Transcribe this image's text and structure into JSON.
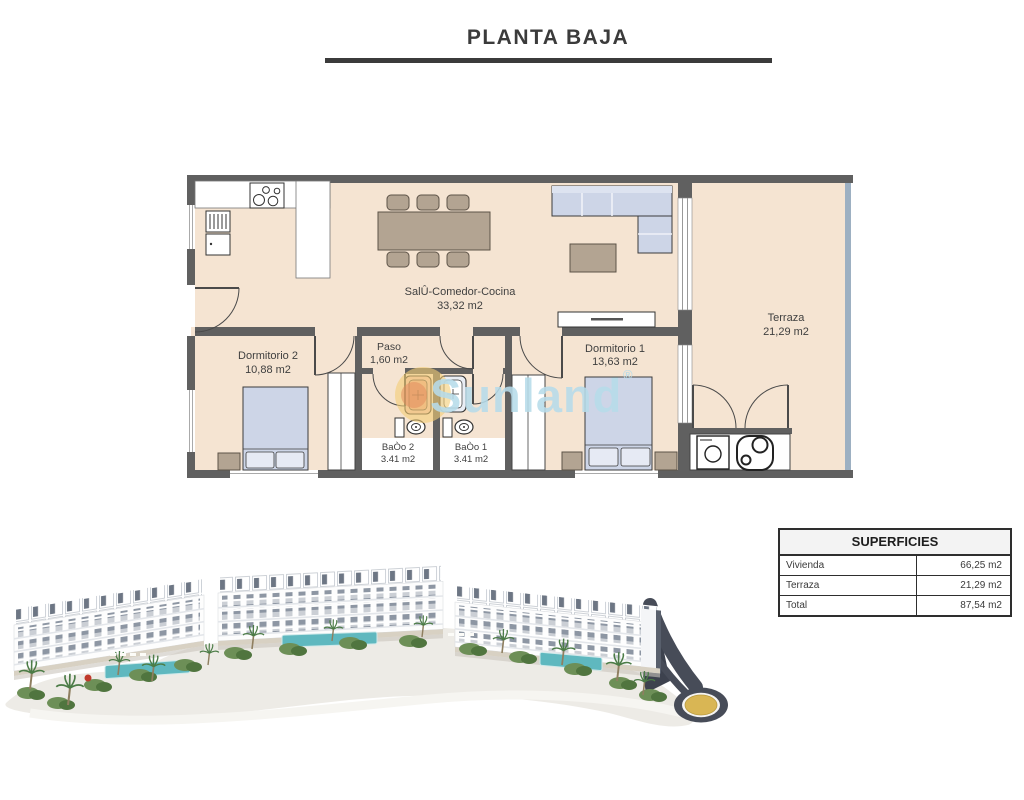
{
  "title": "PLANTA BAJA",
  "floorplan": {
    "rooms": [
      {
        "name": "SalÛ-Comedor-Cocina",
        "area": "33,32 m2"
      },
      {
        "name": "Terraza",
        "area": "21,29 m2"
      },
      {
        "name": "Dormitorio 2",
        "area": "10,88 m2"
      },
      {
        "name": "Dormitorio 1",
        "area": "13,63 m2"
      },
      {
        "name": "Paso",
        "area": "1,60 m2"
      },
      {
        "name": "BaÒo 2",
        "area": "3.41 m2"
      },
      {
        "name": "BaÒo 1",
        "area": "3.41 m2"
      }
    ],
    "watermark": {
      "text": "Sunland",
      "reg": "®"
    }
  },
  "table": {
    "header": "SUPERFICIES",
    "rows": [
      {
        "label": "Vivienda",
        "value": "66,25 m2"
      },
      {
        "label": "Terraza",
        "value": "21,29 m2"
      },
      {
        "label": "Total",
        "value": "87,54 m2"
      }
    ]
  },
  "colors": {
    "floor": "#f5e4d2",
    "wall": "#606060",
    "watermark_blue": "#b7dcea",
    "furniture_wood": "#b3a492",
    "furniture_soft": "#cdd5e7",
    "pool": "#5fb8bf",
    "road": "#474c58",
    "roundabout_gold": "#d9b654"
  }
}
